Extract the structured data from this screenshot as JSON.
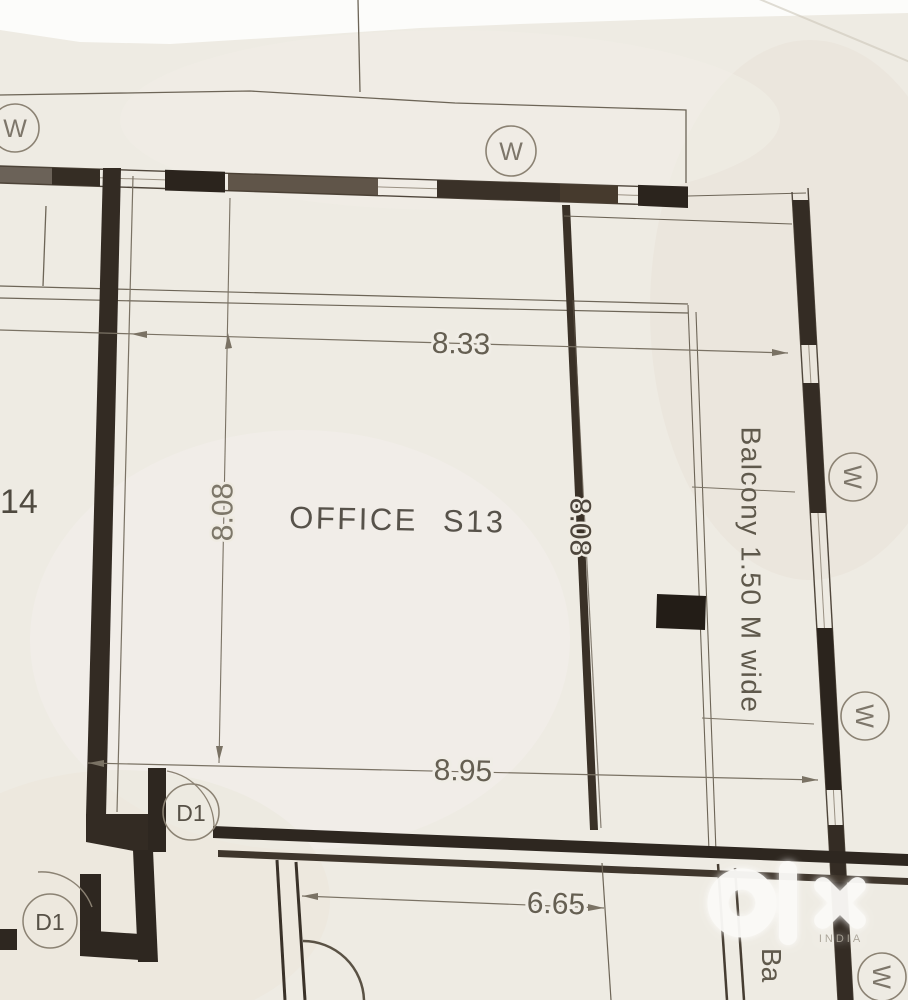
{
  "plan": {
    "room_label": "OFFICE S13",
    "neighbor_room_label": "14",
    "balcony_label": "Balcony 1.50 M wide",
    "balcony_label_partial": "Ba",
    "dimensions": {
      "overall_top": "8.33",
      "room_depth_left": "8.08",
      "room_depth_inner": "8.08",
      "overall_bottom": "8.95",
      "lower_room_width": "6.65"
    },
    "symbols": {
      "window": "W",
      "door": "D1"
    },
    "colors": {
      "paper": "#f0ede6",
      "ink": "#4f463b",
      "wall_fill": "#2e2720",
      "label_text": "#5f594c",
      "watermark": "#fbfaf7"
    }
  },
  "watermark": {
    "brand": "olx",
    "region_label": "INDIA"
  }
}
